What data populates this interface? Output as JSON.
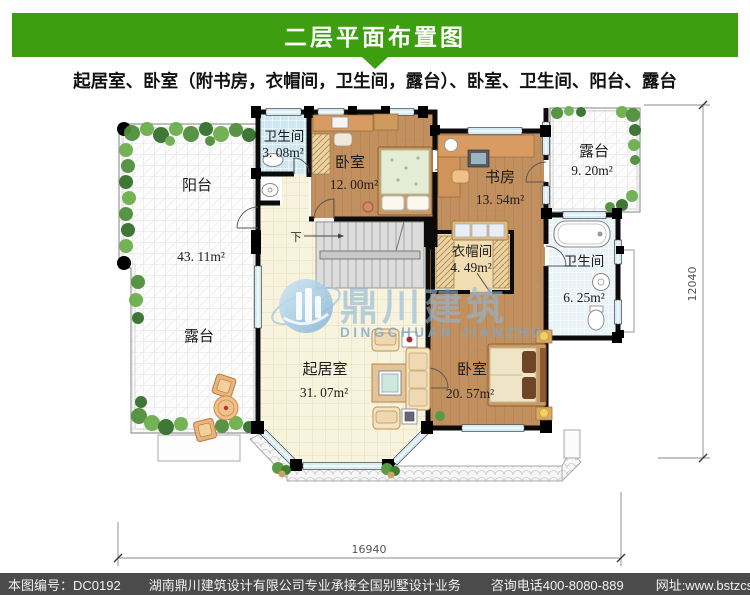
{
  "header": {
    "title": "二层平面布置图",
    "subtitle": "起居室、卧室（附书房，衣帽间，卫生间，露台）、卧室、卫生间、阳台、露台"
  },
  "colors": {
    "banner_green": "#3d9e10",
    "footer_gray": "#4b4b4b",
    "wood_floor": "#c2905f",
    "bath_tile": "#cfe7f0",
    "living_tile": "#f8f3dd",
    "watermark_blue": "#8fb8d8"
  },
  "plan": {
    "rooms": {
      "balcony": {
        "name": "阳台",
        "area": "43. 11m²"
      },
      "terrace_left": {
        "name": "露台"
      },
      "bath_top": {
        "name": "卫生间",
        "area": "3. 08m²"
      },
      "bedroom_top": {
        "name": "卧室",
        "area": "12. 00m²"
      },
      "study": {
        "name": "书房",
        "area": "13. 54m²"
      },
      "terrace_right": {
        "name": "露台",
        "area": "9. 20m²"
      },
      "closet": {
        "name": "衣帽间",
        "area": "4. 49m²"
      },
      "bath_right": {
        "name": "卫生间",
        "area": "6. 25m²"
      },
      "living": {
        "name": "起居室",
        "area": "31. 07m²"
      },
      "bedroom_master": {
        "name": "卧室",
        "area": "20. 57m²"
      }
    },
    "stairs_label": "下",
    "dimensions": {
      "width": "16940",
      "height": "12040"
    }
  },
  "watermark": {
    "cn": "鼎川建筑",
    "en": "DINGCHUAN JIANZHU"
  },
  "footer": {
    "plan_no": "本图编号：DC0192",
    "company": "湖南鼎川建筑设计有限公司专业承接全国别墅设计业务",
    "phone": "咨询电话400-8080-889",
    "website": "网址:www.bstzcs.com"
  }
}
